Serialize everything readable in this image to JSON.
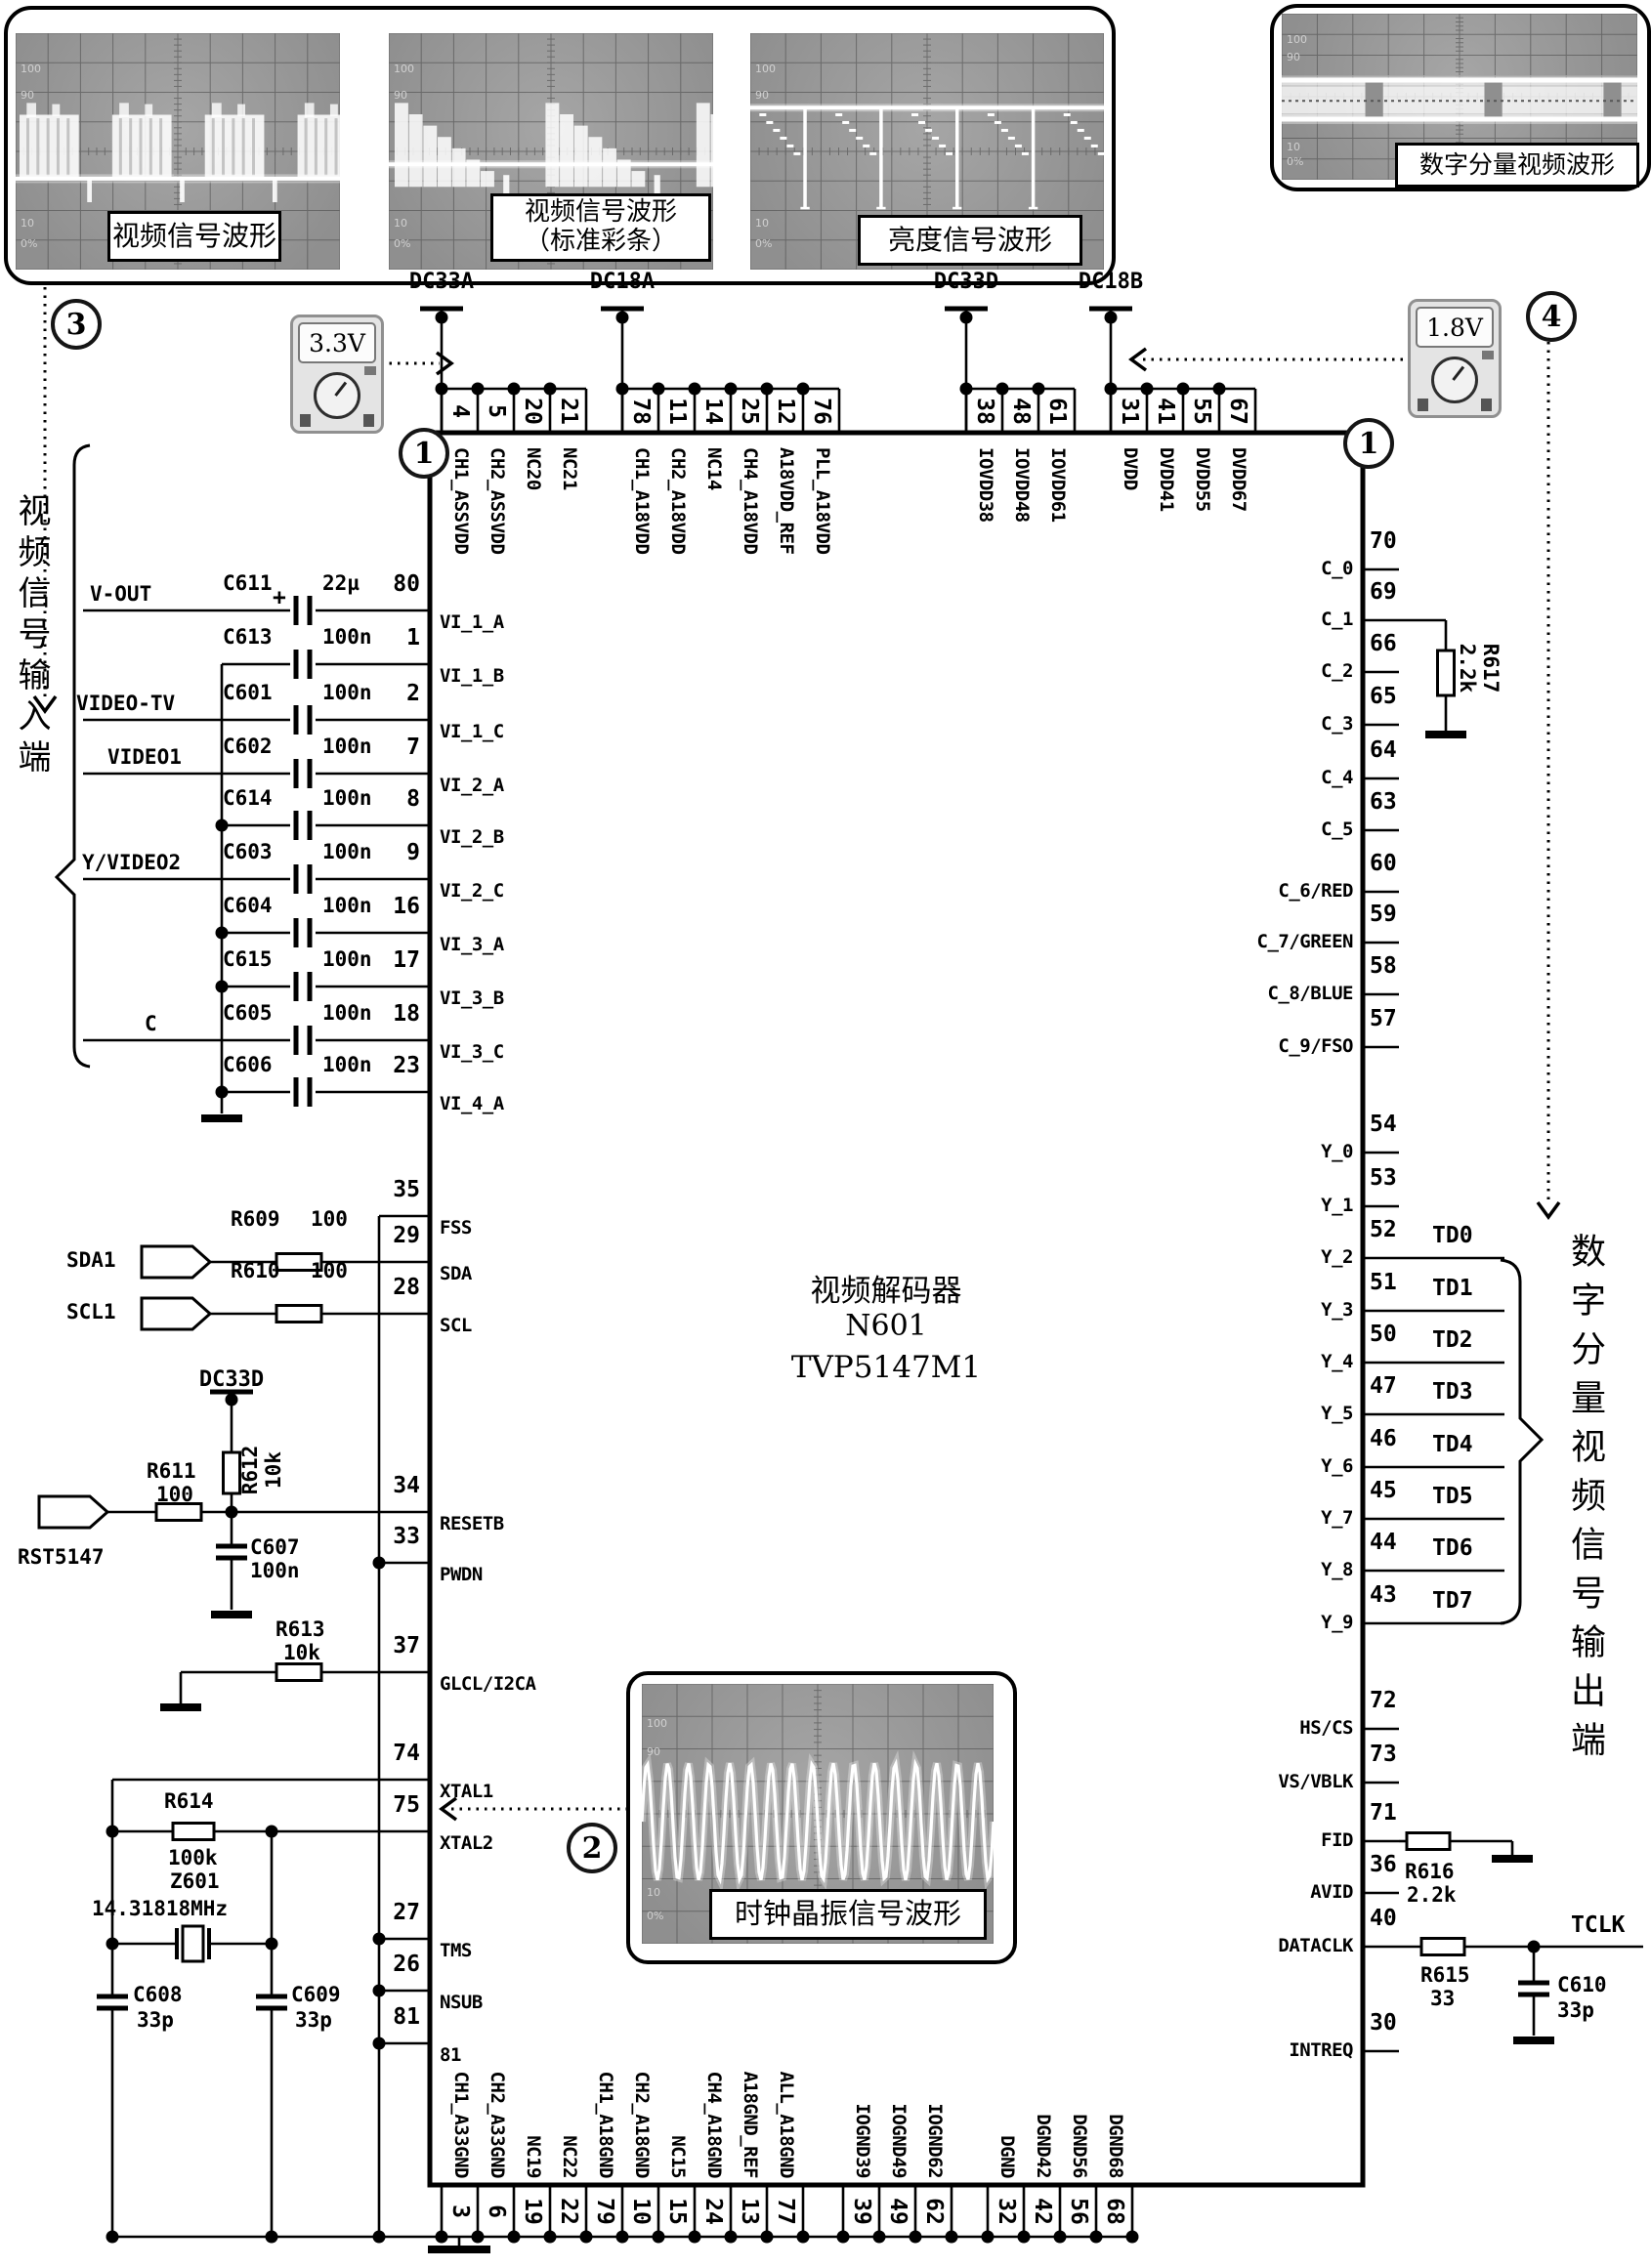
{
  "scopes": [
    {
      "label": "视频信号波形",
      "ticks": [
        "100",
        "90",
        "10",
        "0%"
      ]
    },
    {
      "label": "视频信号波形",
      "label2": "（标准彩条）",
      "ticks": [
        "100",
        "90",
        "10",
        "0%"
      ]
    },
    {
      "label": "亮度信号波形",
      "ticks": [
        "100",
        "90",
        "10",
        "0%"
      ]
    },
    {
      "label": "数字分量视频波形",
      "ticks": [
        "100",
        "90",
        "10",
        "0%"
      ]
    }
  ],
  "clock_scope": {
    "label": "时钟晶振信号波形",
    "ticks": [
      "100",
      "90",
      "10",
      "0%"
    ]
  },
  "callouts": {
    "one": "1",
    "two": "2",
    "three": "3",
    "four": "4"
  },
  "meters": {
    "left_value": "3.3V",
    "right_value": "1.8V"
  },
  "power_rails": [
    {
      "name": "DC33A",
      "pins": [
        "4",
        "5",
        "20",
        "21"
      ]
    },
    {
      "name": "DC18A",
      "pins": [
        "78",
        "11",
        "14",
        "25",
        "12",
        "76"
      ]
    },
    {
      "name": "DC33D",
      "pins": [
        "38",
        "48",
        "61"
      ]
    },
    {
      "name": "DC18B",
      "pins": [
        "31",
        "41",
        "55",
        "67"
      ]
    }
  ],
  "chip": {
    "title": "视频解码器",
    "designator": "N601",
    "part": "TVP5147M1",
    "top_pin_names": [
      "CH1_ASSVDD",
      "CH2_ASSVDD",
      "NC20",
      "NC21",
      "CH1_A18VDD",
      "CH2_A18VDD",
      "NC14",
      "CH4_A18VDD",
      "A18VDD_REF",
      "PLL_A18VDD",
      "IOVDD38",
      "IOVDD48",
      "IOVDD61",
      "DVDD",
      "DVDD41",
      "DVDD55",
      "DVDD67"
    ],
    "bottom_pins": [
      {
        "num": "3",
        "name": "CH1_A33GND"
      },
      {
        "num": "6",
        "name": "CH2_A33GND"
      },
      {
        "num": "19",
        "name": "NC19"
      },
      {
        "num": "22",
        "name": "NC22"
      },
      {
        "num": "79",
        "name": "CH1_A18GND"
      },
      {
        "num": "10",
        "name": "CH2_A18GND"
      },
      {
        "num": "15",
        "name": "NC15"
      },
      {
        "num": "24",
        "name": "CH4_A18GND"
      },
      {
        "num": "13",
        "name": "A18GND_REF"
      },
      {
        "num": "77",
        "name": "ALL_A18GND"
      },
      {
        "num": "39",
        "name": "IOGND39"
      },
      {
        "num": "49",
        "name": "IOGND49"
      },
      {
        "num": "62",
        "name": "IOGND62"
      },
      {
        "num": "32",
        "name": "DGND"
      },
      {
        "num": "42",
        "name": "DGND42"
      },
      {
        "num": "56",
        "name": "DGND56"
      },
      {
        "num": "68",
        "name": "DGND68"
      }
    ],
    "left_pins": [
      {
        "num": "80",
        "name": "VI_1_A"
      },
      {
        "num": "1",
        "name": "VI_1_B"
      },
      {
        "num": "2",
        "name": "VI_1_C"
      },
      {
        "num": "7",
        "name": "VI_2_A"
      },
      {
        "num": "8",
        "name": "VI_2_B"
      },
      {
        "num": "9",
        "name": "VI_2_C"
      },
      {
        "num": "16",
        "name": "VI_3_A"
      },
      {
        "num": "17",
        "name": "VI_3_B"
      },
      {
        "num": "18",
        "name": "VI_3_C"
      },
      {
        "num": "23",
        "name": "VI_4_A"
      },
      {
        "num": "35",
        "name": "FSS"
      },
      {
        "num": "29",
        "name": "SDA"
      },
      {
        "num": "28",
        "name": "SCL"
      },
      {
        "num": "34",
        "name": "RESETB"
      },
      {
        "num": "33",
        "name": "PWDN"
      },
      {
        "num": "37",
        "name": "GLCL/I2CA"
      },
      {
        "num": "74",
        "name": "XTAL1"
      },
      {
        "num": "75",
        "name": "XTAL2"
      },
      {
        "num": "27",
        "name": "TMS"
      },
      {
        "num": "26",
        "name": "NSUB"
      },
      {
        "num": "81",
        "name": "81"
      }
    ],
    "right_pins": [
      {
        "num": "70",
        "name": "C_0"
      },
      {
        "num": "69",
        "name": "C_1"
      },
      {
        "num": "66",
        "name": "C_2"
      },
      {
        "num": "65",
        "name": "C_3"
      },
      {
        "num": "64",
        "name": "C_4"
      },
      {
        "num": "63",
        "name": "C_5"
      },
      {
        "num": "60",
        "name": "C_6/RED"
      },
      {
        "num": "59",
        "name": "C_7/GREEN"
      },
      {
        "num": "58",
        "name": "C_8/BLUE"
      },
      {
        "num": "57",
        "name": "C_9/FSO"
      },
      {
        "num": "54",
        "name": "Y_0"
      },
      {
        "num": "53",
        "name": "Y_1"
      },
      {
        "num": "52",
        "name": "Y_2",
        "td": "TD0"
      },
      {
        "num": "51",
        "name": "Y_3",
        "td": "TD1"
      },
      {
        "num": "50",
        "name": "Y_4",
        "td": "TD2"
      },
      {
        "num": "47",
        "name": "Y_5",
        "td": "TD3"
      },
      {
        "num": "46",
        "name": "Y_6",
        "td": "TD4"
      },
      {
        "num": "45",
        "name": "Y_7",
        "td": "TD5"
      },
      {
        "num": "44",
        "name": "Y_8",
        "td": "TD6"
      },
      {
        "num": "43",
        "name": "Y_9",
        "td": "TD7"
      },
      {
        "num": "72",
        "name": "HS/CS"
      },
      {
        "num": "73",
        "name": "VS/VBLK"
      },
      {
        "num": "71",
        "name": "FID"
      },
      {
        "num": "36",
        "name": "AVID"
      },
      {
        "num": "40",
        "name": "DATACLK"
      },
      {
        "num": "30",
        "name": "INTREQ"
      }
    ]
  },
  "video_inputs": {
    "brace_label": "视频信号输入端",
    "rows": [
      {
        "input": "V-OUT",
        "plus": "+",
        "cap": "C611",
        "value": "22µ"
      },
      {
        "cap": "C613",
        "value": "100n"
      },
      {
        "input": "VIDEO-TV",
        "cap": "C601",
        "value": "100n"
      },
      {
        "input": "VIDEO1",
        "cap": "C602",
        "value": "100n"
      },
      {
        "cap": "C614",
        "value": "100n"
      },
      {
        "input": "Y/VIDEO2",
        "cap": "C603",
        "value": "100n"
      },
      {
        "cap": "C604",
        "value": "100n"
      },
      {
        "cap": "C615",
        "value": "100n"
      },
      {
        "input": "C",
        "cap": "C605",
        "value": "100n"
      },
      {
        "cap": "C606",
        "value": "100n"
      }
    ]
  },
  "i2c": {
    "sda_conn": "SDA1",
    "scl_conn": "SCL1",
    "r_sda": {
      "ref": "R609",
      "value": "100"
    },
    "r_scl": {
      "ref": "R610",
      "value": "100"
    }
  },
  "reset": {
    "conn": "RST5147",
    "rail": "DC33D",
    "r_series": {
      "ref": "R611",
      "value": "100"
    },
    "r_pullup": {
      "ref": "R612",
      "value": "10k"
    },
    "cap": {
      "ref": "C607",
      "value": "100n"
    }
  },
  "glcl": {
    "r": {
      "ref": "R613",
      "value": "10k"
    }
  },
  "xtal": {
    "r": {
      "ref": "R614",
      "value": "100k"
    },
    "crystal": {
      "ref": "Z601",
      "value": "14.31818MHz"
    },
    "c1": {
      "ref": "C608",
      "value": "33p"
    },
    "c2": {
      "ref": "C609",
      "value": "33p"
    }
  },
  "right_side": {
    "r_c1": {
      "ref": "R617",
      "value": "2.2k"
    },
    "td_labels": [
      "TD0",
      "TD1",
      "TD2",
      "TD3",
      "TD4",
      "TD5",
      "TD6",
      "TD7"
    ],
    "output_label": "数字分量视频信号输出端",
    "r_fid": {
      "ref": "R616",
      "value": "2.2k"
    },
    "r_clk": {
      "ref": "R615",
      "value": "33"
    },
    "c_clk": {
      "ref": "C610",
      "value": "33p"
    },
    "tclk": "TCLK"
  }
}
